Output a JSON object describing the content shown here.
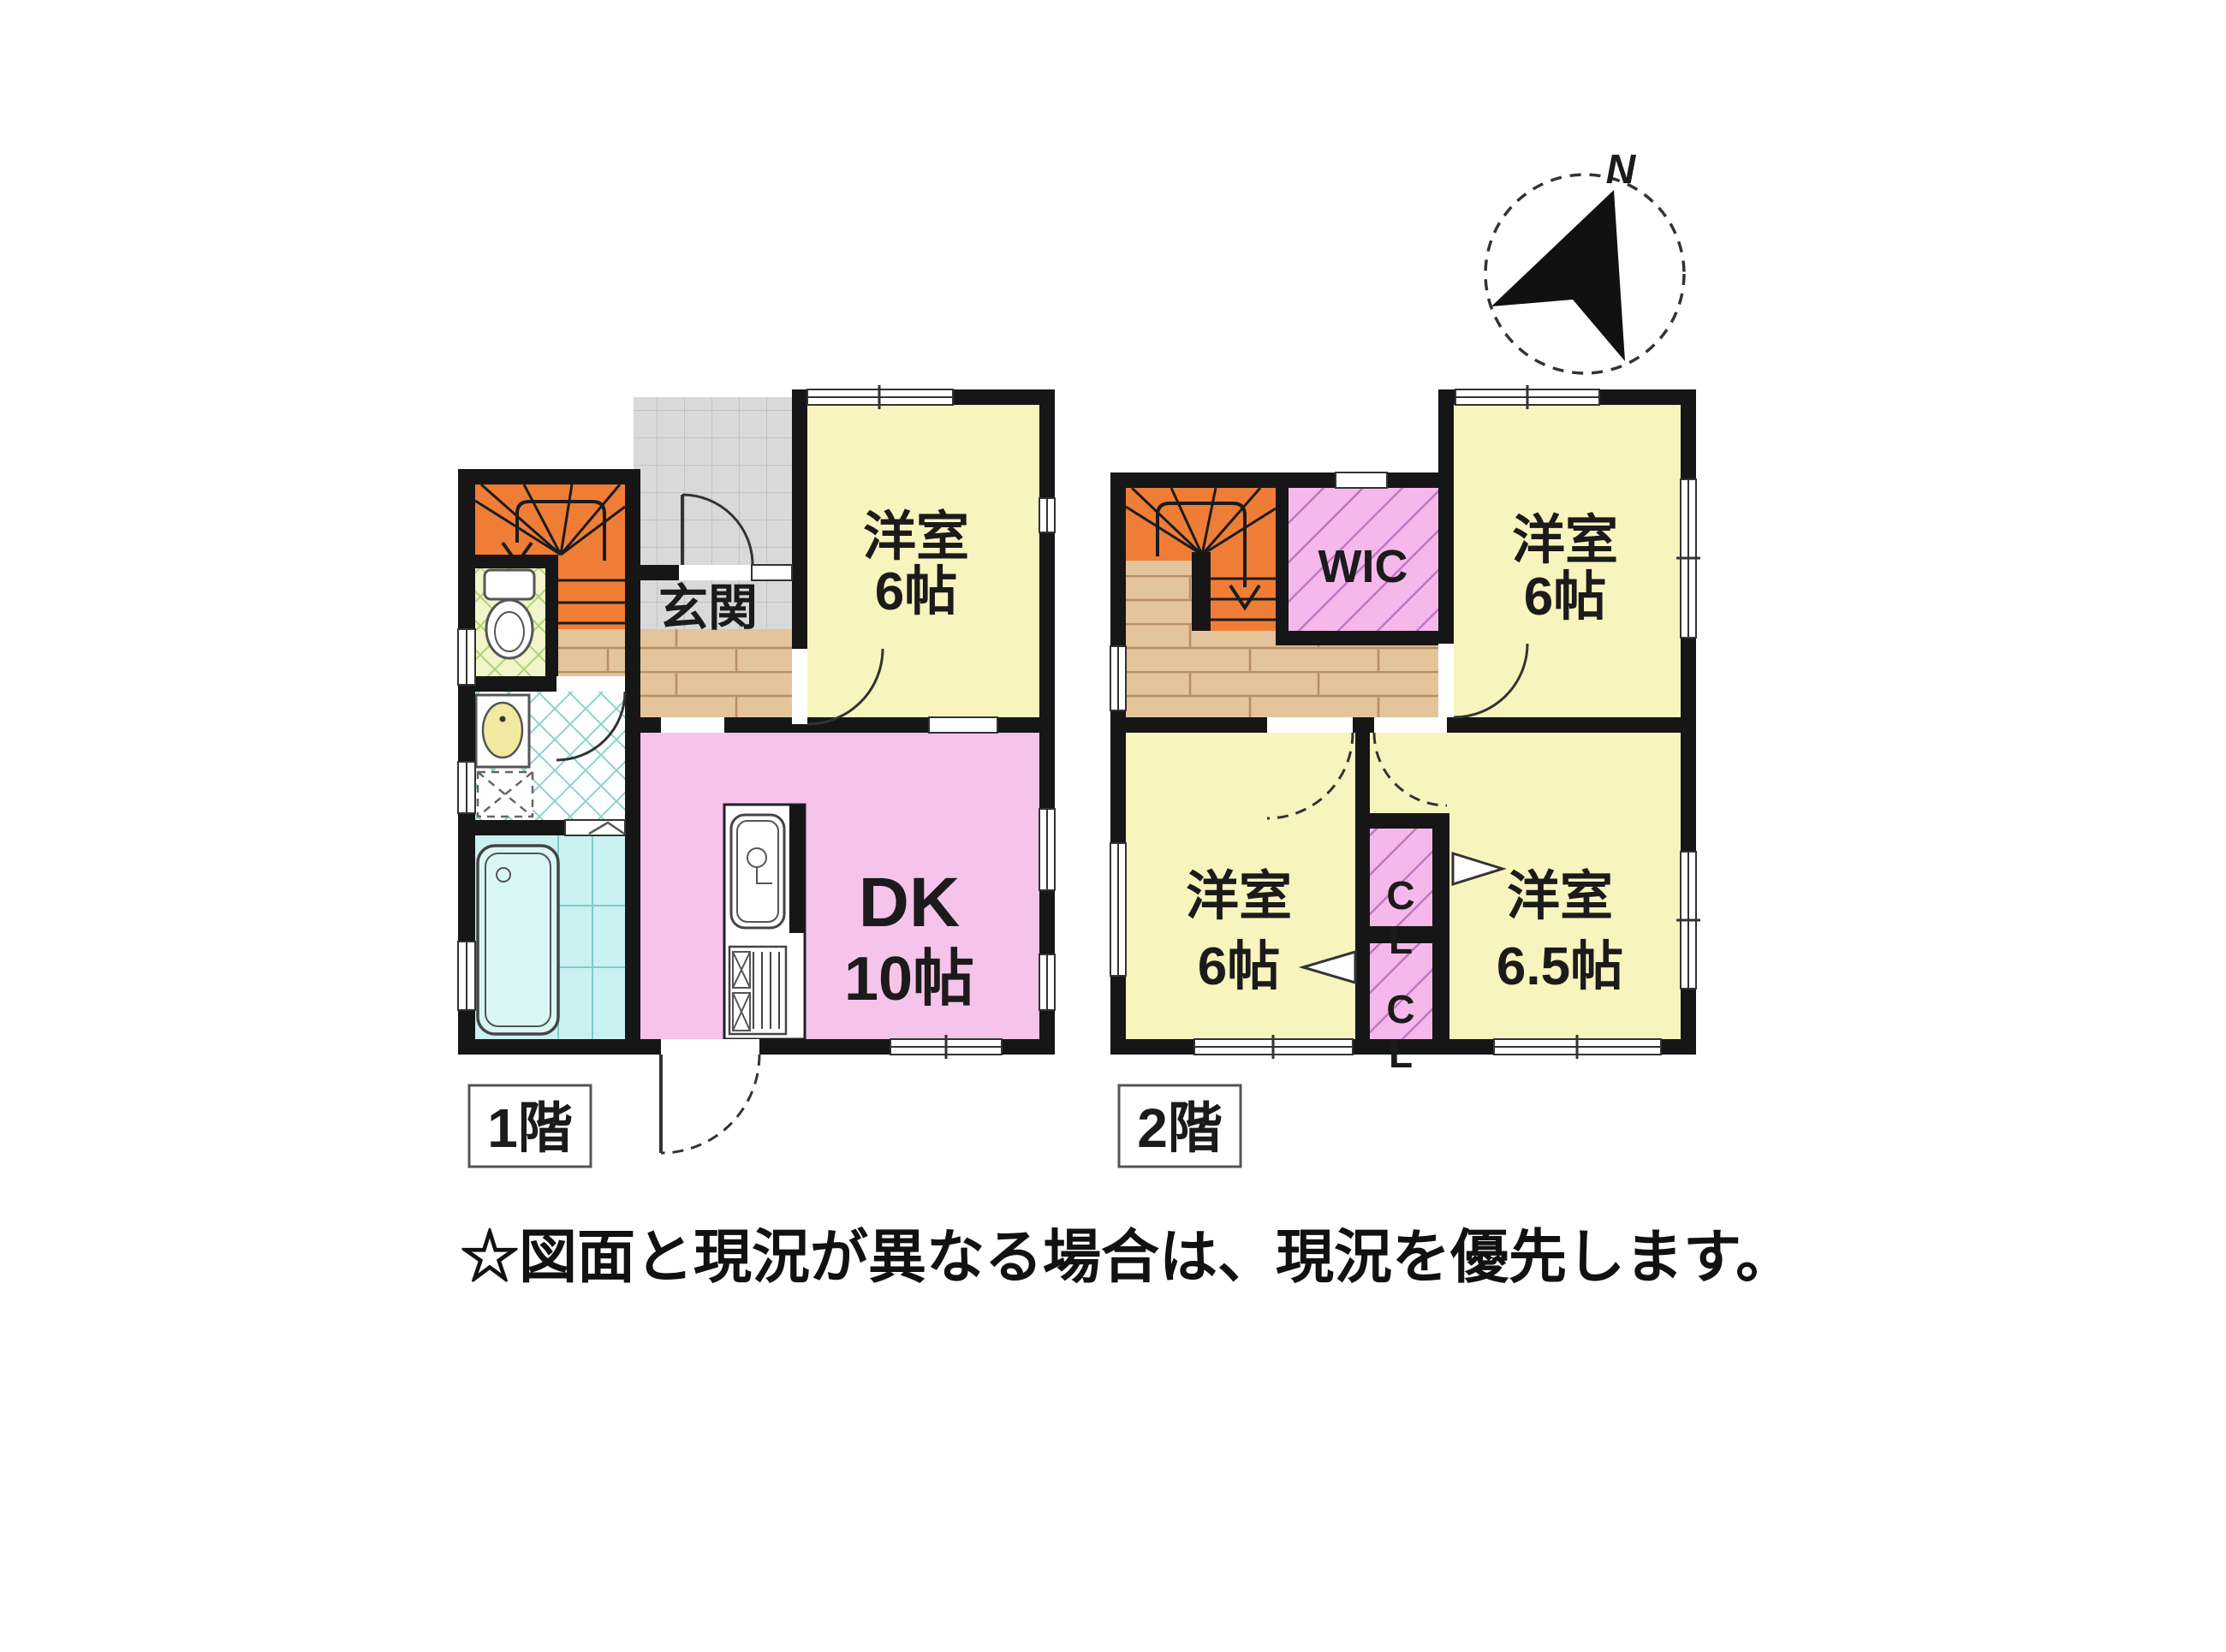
{
  "note": {
    "disclaimer": "☆図面と現況が異なる場合は、現況を優先します。"
  },
  "compass": {
    "north_label": "N"
  },
  "floor1": {
    "badge": "1階",
    "entrance_label": "玄関",
    "western_room": {
      "name": "洋室",
      "size": "6帖"
    },
    "dk": {
      "name": "DK",
      "size": "10帖"
    }
  },
  "floor2": {
    "badge": "2階",
    "wic_label": "WIC",
    "room_ne": {
      "name": "洋室",
      "size": "6帖"
    },
    "room_sw": {
      "name": "洋室",
      "size": "6帖"
    },
    "room_se": {
      "name": "洋室",
      "size": "6.5帖"
    },
    "closet_upper_label": "CL",
    "closet_lower_label": "CL"
  },
  "colors": {
    "wall": "#161616",
    "room_yellow": "#f8f4bd",
    "dk_pink": "#f6c3ea",
    "closet_pink": "#f4b9ea",
    "stairs_orange": "#ef7d36",
    "bath_cyan": "#c9f1f1",
    "wood": "#e3c49b",
    "tile_gray": "#d9d9d9"
  }
}
